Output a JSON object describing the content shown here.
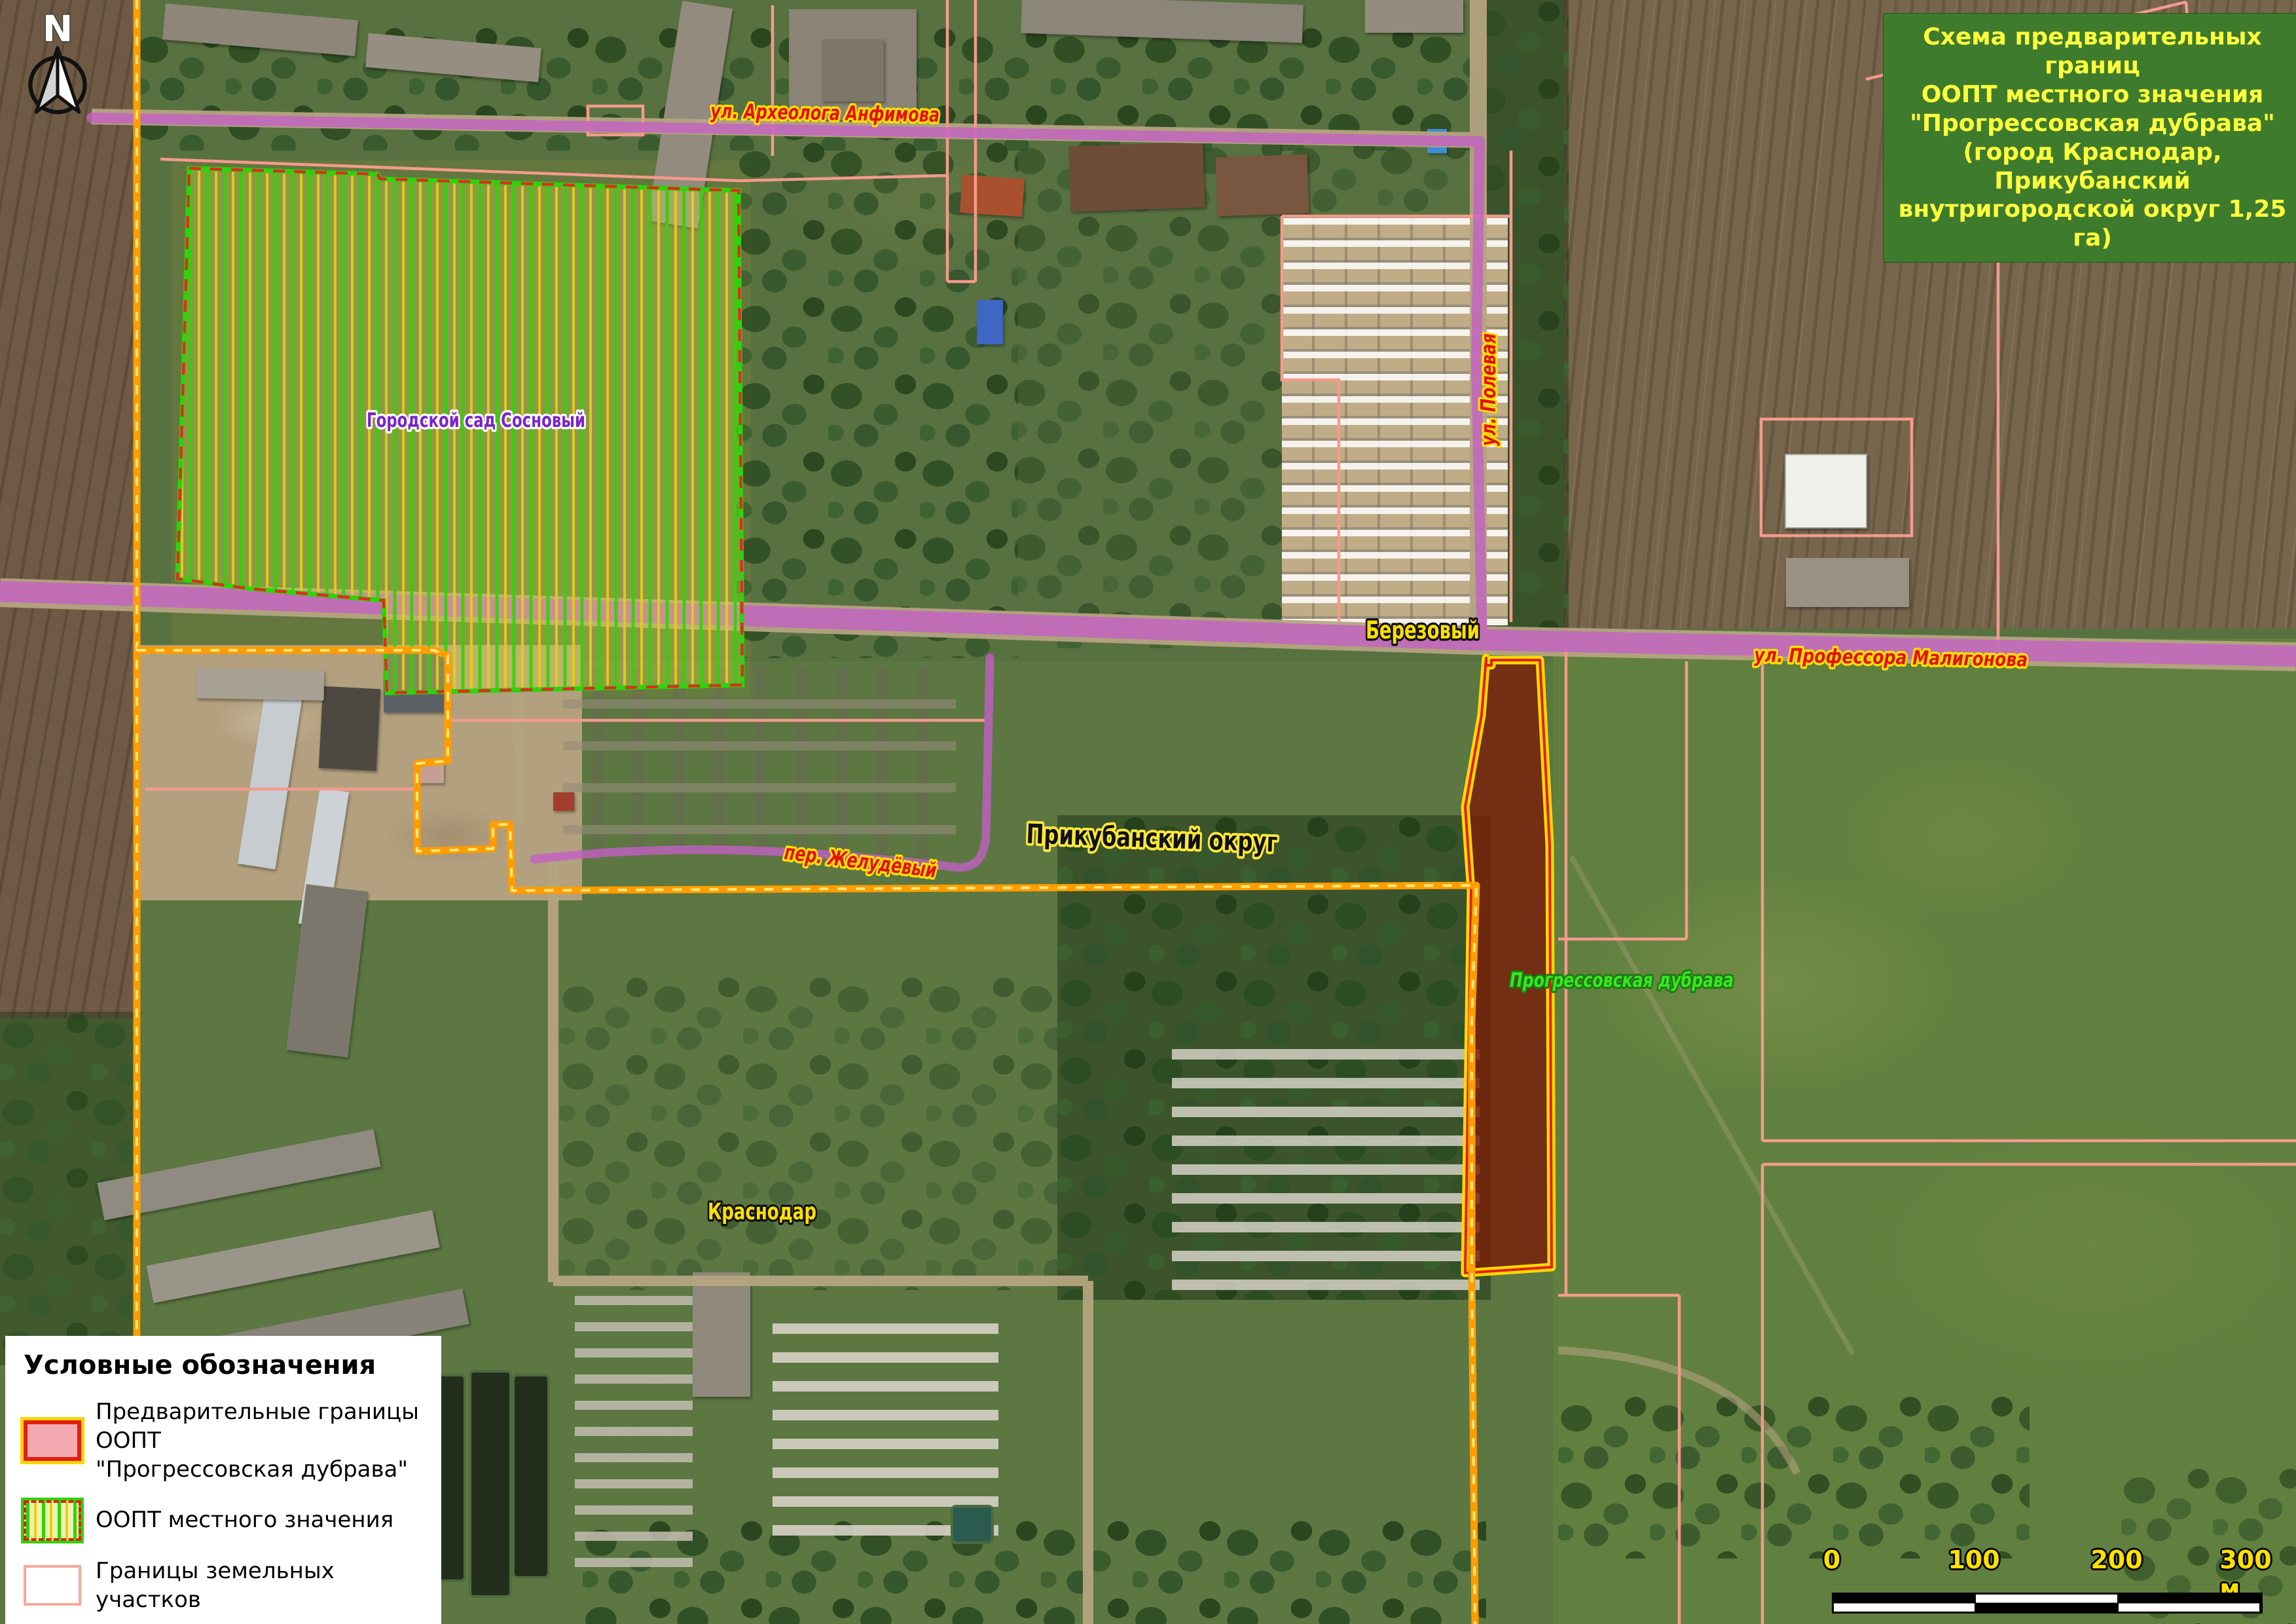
{
  "title_box": {
    "text": "Схема предварительных границ\nООПТ местного значения\n\"Прогрессовская дубрава\"\n(город Краснодар, Прикубанский\nвнутригородской округ 1,25 га)"
  },
  "north": {
    "label": "N"
  },
  "map_labels": {
    "anfimova": "ул. Археолога Анфимова",
    "polevaya": "ул. Полевая",
    "maligonova": "ул. Профессора Малигонова",
    "zheludevy": "пер. Желудёвый",
    "berezovy": "Березовый",
    "prikubansky": "Прикубанский округ",
    "krasnodar": "Краснодар",
    "sosnovy": "Городской сад Сосновый",
    "progressovskaya": "Прогрессовская дубрава"
  },
  "legend": {
    "title": "Условные обозначения",
    "items": [
      {
        "line1": "Предварительные границы ООПТ",
        "line2": "\"Прогрессовская дубрава\"",
        "symbol": "preliminary-oopt-boundary"
      },
      {
        "line1": "ООПТ местного значения",
        "symbol": "local-oopt-hatched"
      },
      {
        "line1": "Границы земельных участков",
        "symbol": "land-parcel-boundary"
      },
      {
        "line1": "Границы населенных пунктов",
        "symbol": "settlement-boundary"
      }
    ]
  },
  "scale_bar": {
    "tick0": "0",
    "tick1": "100",
    "tick2": "200",
    "tick3": "300 м"
  },
  "colors": {
    "road_purple": "#c45fc6",
    "parcel_pink": "#f59a8c",
    "settlement_boundary_orange": "#ff9d00",
    "settlement_boundary_dash_yellow": "#ffe878",
    "oopt_border_green": "#2dd409",
    "oopt_hatch_yellow": "#e3cf1b",
    "oopt_prelim_border_yellow": "#ffd900",
    "oopt_prelim_border_red": "#e21f10",
    "oopt_prelim_fill": "#7a1e08",
    "title_bg": "#3e7b2d",
    "title_text": "#feff3c",
    "street_label_red": "#e21212",
    "street_label_halo": "#ffe000"
  }
}
